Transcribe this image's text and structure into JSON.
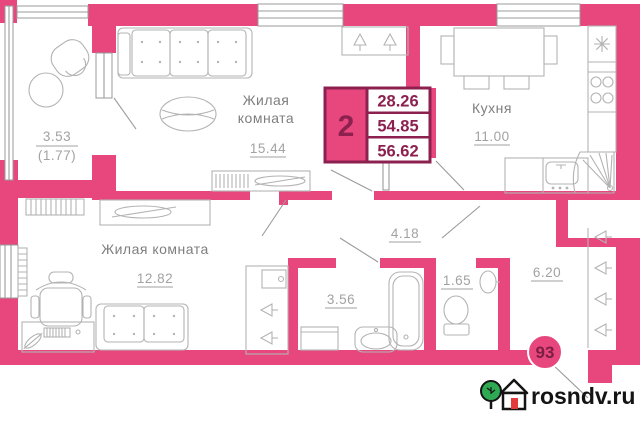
{
  "colors": {
    "wall_pink": "#e8477e",
    "summary_frame": "#8c2150",
    "summary_text": "#8c2150",
    "room_label_gray": "#7e7e7e",
    "area_number_gray": "#a2a2a2",
    "furniture_gray": "#b3b3b3",
    "badge_fill": "#e8477e",
    "badge_text": "#7a1f42",
    "logo_tree_green": "#2faa53",
    "logo_door_red": "#e23b3b",
    "logo_text_black": "#141414"
  },
  "summary_box": {
    "rooms_count": "2",
    "row1": "28.26",
    "row2": "54.85",
    "row3": "56.62"
  },
  "rooms": {
    "living1": {
      "label_line1": "Жилая",
      "label_line2": "комната",
      "area": "15.44"
    },
    "living2": {
      "label": "Жилая комната",
      "area": "12.82"
    },
    "kitchen": {
      "label": "Кухня",
      "area": "11.00"
    },
    "balcony": {
      "area": "3.53",
      "area_coef": "(1.77)"
    },
    "corridor": {
      "area": "4.18"
    },
    "bathroom": {
      "area": "3.56"
    },
    "wc": {
      "area": "1.65"
    },
    "hallway": {
      "area": "6.20"
    }
  },
  "badge": {
    "flat_number": "93"
  },
  "watermark": {
    "site": "rosndv.ru"
  }
}
